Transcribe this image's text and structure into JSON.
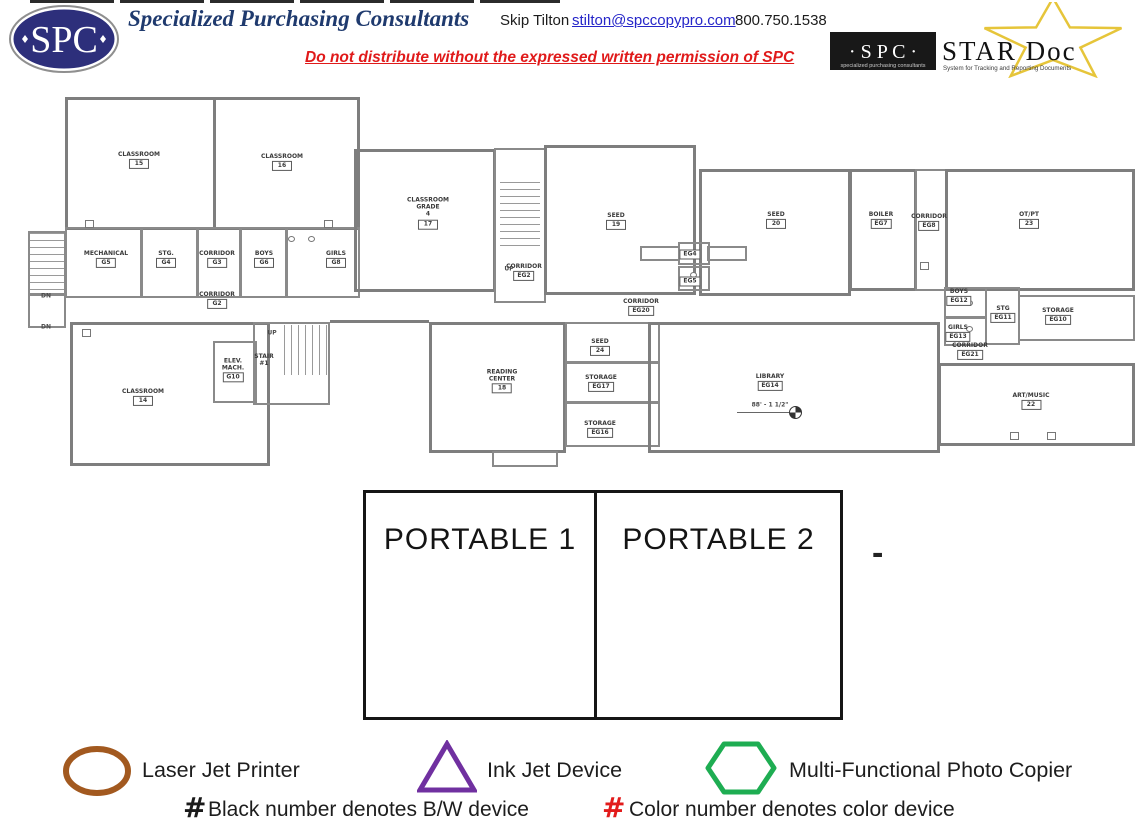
{
  "header": {
    "logo_text": "SPC",
    "company": "Specialized Purchasing Consultants",
    "contact_name": "Skip Tilton",
    "contact_email": "stilton@spccopypro.com",
    "contact_phone": "800.750.1538",
    "warning": "Do not distribute without the expressed written permission of SPC",
    "stardoc": {
      "spc": "· S P C ·",
      "spc_caption": "specialized purchasing consultants",
      "name": "STAR Doc",
      "tagline": "System for Tracking and Reporting Documents",
      "star_color": "#e6c53a"
    }
  },
  "floorplan": {
    "rooms": [
      {
        "lines": [
          "CLASSROOM"
        ],
        "id": "15",
        "x": 139,
        "y": 160
      },
      {
        "lines": [
          "CLASSROOM"
        ],
        "id": "16",
        "x": 282,
        "y": 162
      },
      {
        "lines": [
          "MECHANICAL"
        ],
        "id": "G5",
        "x": 106,
        "y": 259
      },
      {
        "lines": [
          "STG."
        ],
        "id": "G4",
        "x": 166,
        "y": 259
      },
      {
        "lines": [
          "CORRIDOR"
        ],
        "id": "G3",
        "x": 217,
        "y": 259
      },
      {
        "lines": [
          "BOYS"
        ],
        "id": "G6",
        "x": 264,
        "y": 259
      },
      {
        "lines": [
          "GIRLS"
        ],
        "id": "G8",
        "x": 336,
        "y": 259
      },
      {
        "lines": [
          "CORRIDOR"
        ],
        "id": "G2",
        "x": 217,
        "y": 300
      },
      {
        "lines": [
          "CLASSROOM"
        ],
        "id": "14",
        "x": 143,
        "y": 397
      },
      {
        "lines": [
          "ELEV.",
          "MACH."
        ],
        "id": "G10",
        "x": 233,
        "y": 370
      },
      {
        "lines": [
          "STAIR",
          "#1"
        ],
        "id": "",
        "x": 264,
        "y": 360
      },
      {
        "lines": [
          "CLASSROOM",
          "GRADE",
          "4"
        ],
        "id": "17",
        "x": 428,
        "y": 213
      },
      {
        "lines": [
          "CORRIDOR"
        ],
        "id": "EG2",
        "x": 524,
        "y": 272
      },
      {
        "lines": [
          "SEED"
        ],
        "id": "19",
        "x": 616,
        "y": 221
      },
      {
        "lines": [],
        "id": "EG4",
        "x": 690,
        "y": 254
      },
      {
        "lines": [],
        "id": "EG5",
        "x": 690,
        "y": 281
      },
      {
        "lines": [
          "SEED"
        ],
        "id": "20",
        "x": 776,
        "y": 220
      },
      {
        "lines": [
          "BOILER"
        ],
        "id": "EG7",
        "x": 881,
        "y": 220
      },
      {
        "lines": [
          "CORRIDOR"
        ],
        "id": "EG8",
        "x": 929,
        "y": 222
      },
      {
        "lines": [
          "OT/PT"
        ],
        "id": "23",
        "x": 1029,
        "y": 220
      },
      {
        "lines": [
          "CORRIDOR"
        ],
        "id": "EG20",
        "x": 641,
        "y": 307
      },
      {
        "lines": [
          "BOYS"
        ],
        "id": "EG12",
        "x": 959,
        "y": 297
      },
      {
        "lines": [
          "STG"
        ],
        "id": "EG11",
        "x": 1003,
        "y": 314
      },
      {
        "lines": [
          "STORAGE"
        ],
        "id": "EG10",
        "x": 1058,
        "y": 316
      },
      {
        "lines": [
          "GIRLS"
        ],
        "id": "EG13",
        "x": 958,
        "y": 333
      },
      {
        "lines": [
          "CORRIDOR"
        ],
        "id": "EG21",
        "x": 970,
        "y": 351
      },
      {
        "lines": [
          "READING",
          "CENTER"
        ],
        "id": "18",
        "x": 502,
        "y": 381
      },
      {
        "lines": [
          "SEED"
        ],
        "id": "24",
        "x": 600,
        "y": 347
      },
      {
        "lines": [
          "STORAGE"
        ],
        "id": "EG17",
        "x": 601,
        "y": 383
      },
      {
        "lines": [
          "STORAGE"
        ],
        "id": "EG16",
        "x": 600,
        "y": 429
      },
      {
        "lines": [
          "LIBRARY"
        ],
        "id": "EG14",
        "x": 770,
        "y": 382
      },
      {
        "lines": [
          "ART/MUSIC"
        ],
        "id": "22",
        "x": 1031,
        "y": 401
      }
    ],
    "annotations": [
      {
        "text": "UP",
        "x": 509,
        "y": 269
      },
      {
        "text": "UP",
        "x": 272,
        "y": 333
      },
      {
        "text": "DN",
        "x": 46,
        "y": 296
      },
      {
        "text": "DN",
        "x": 46,
        "y": 327
      },
      {
        "text": "88' - 1 1/2\"",
        "x": 770,
        "y": 405
      }
    ]
  },
  "portables": {
    "items": [
      {
        "label": "PORTABLE 1"
      },
      {
        "label": "PORTABLE 2"
      }
    ],
    "dash": "-"
  },
  "legend": {
    "items": [
      {
        "shape": "oval",
        "color": "#a2591f",
        "label": "Laser Jet Printer"
      },
      {
        "shape": "triangle",
        "color": "#7030a0",
        "label": "Ink Jet Device"
      },
      {
        "shape": "hexagon",
        "color": "#1ead52",
        "label": "Multi-Functional Photo Copier"
      }
    ],
    "notes": [
      {
        "symbol": "#",
        "symbol_color": "#1a1a1a",
        "text": "Black number denotes B/W device"
      },
      {
        "symbol": "#",
        "symbol_color": "#e21b1b",
        "text": "Color number denotes color device"
      }
    ]
  }
}
